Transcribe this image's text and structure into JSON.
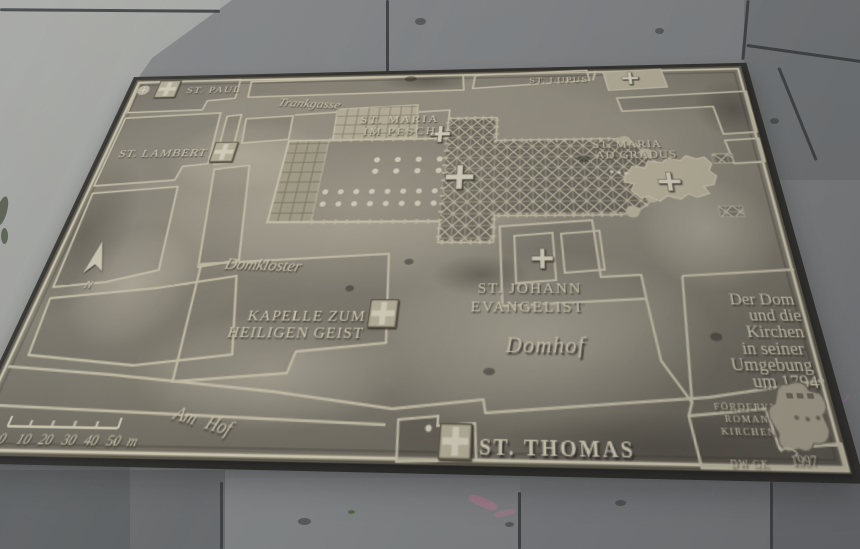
{
  "plaque": {
    "title_lines": [
      "Der Dom",
      "und die",
      "Kirchen",
      "in seiner",
      "Umgebung",
      "um 1794"
    ],
    "credit_lines": [
      "FÖRDERVEREIN",
      "ROMANISCHE",
      "KIRCHEN KÖLN"
    ],
    "year": "1997",
    "initials": "DW GK",
    "churches": {
      "st_paul": "ST. PAUL",
      "st_lambert": "ST. LAMBERT",
      "st_lupus": "ST. LUPUS",
      "st_maria_im_pesch": [
        "ST. MARIA",
        "IM PESCH"
      ],
      "st_maria_ad_gradus": [
        "ST. MARIA",
        "AD GRADUS"
      ],
      "st_johann_evangelist": [
        "ST. JOHANN",
        "EVANGELIST"
      ],
      "kapelle_zum_heiligen_geist": [
        "KAPELLE ZUM",
        "HEILIGEN GEIST"
      ],
      "st_thomas": "ST. THOMAS"
    },
    "streets": {
      "trankgasse": "Trankgasse",
      "domkloster": "Domkloster",
      "domhof": "Domhof",
      "am_hof": "Am Hof"
    },
    "compass": {
      "north": "N"
    },
    "scale_bar": {
      "ticks": [
        "0",
        "10",
        "20",
        "30",
        "40",
        "50"
      ],
      "unit": "m"
    },
    "colors": {
      "bronze_base": "#948e7d",
      "bronze_light": "#e9e1c6",
      "bronze_dark": "#55503f",
      "granite": "#84878a",
      "concrete": "#b5b7b4",
      "chalk_pink": "#d583a8"
    }
  }
}
